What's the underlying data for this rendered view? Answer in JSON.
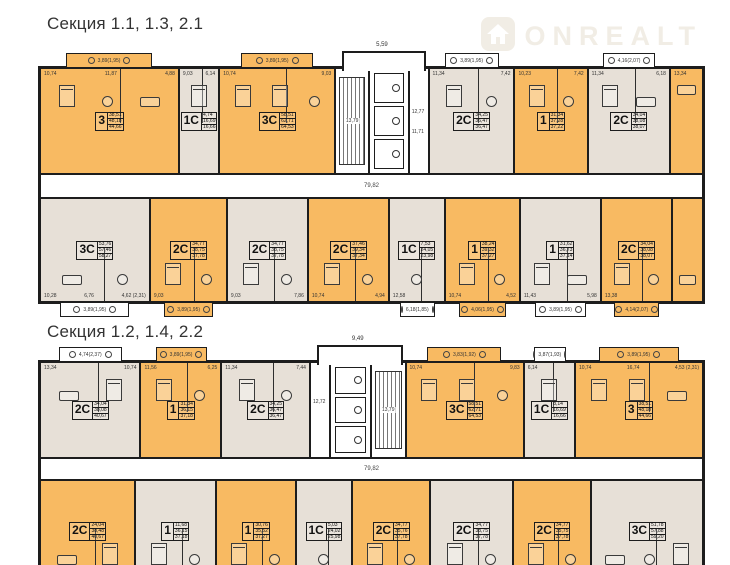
{
  "watermark": {
    "brand": "ONREALT",
    "color": "#f1ede5"
  },
  "colors": {
    "orange": "#f8ba62",
    "beige": "#e7e0d7",
    "wall": "#1d1d1d"
  },
  "sections": [
    {
      "title": "Секция 1.1, 1.3, 2.1",
      "corridor_label": "79,82",
      "core": {
        "stair_dim": "13,79",
        "hall_dims": [
          "12,77",
          "11,71"
        ],
        "top_dim": "5,59",
        "mirror": false
      },
      "rows": [
        {
          "units": [
            {
              "label": "3",
              "fill": "orange",
              "w": 150,
              "areas": [
                "38,51",
                "48,18",
                "44,66"
              ],
              "dims": [
                "10,74",
                "11,87",
                "4,88"
              ],
              "furn": [
                "bed",
                "table",
                "sofa"
              ],
              "balcony_top": "3,89(1,95)"
            },
            {
              "label": "1С",
              "fill": "beige",
              "w": 42,
              "areas": [
                "4,74",
                "16,69",
                "16,66"
              ],
              "dims": [
                "9,03",
                "6,14"
              ],
              "furn": [
                "bed"
              ]
            },
            {
              "label": "3С",
              "fill": "orange",
              "w": 125,
              "areas": [
                "58,51",
                "62,71",
                "64,53"
              ],
              "dims": [
                "10,74",
                "9,03"
              ],
              "furn": [
                "bed",
                "bed",
                "table"
              ],
              "balcony_top": "3,89(1,95)"
            },
            {
              "kind": "core",
              "w": 100
            },
            {
              "label": "2С",
              "fill": "beige",
              "w": 92,
              "areas": [
                "34,25",
                "36,47",
                "36,47"
              ],
              "dims": [
                "11,34",
                "7,42"
              ],
              "furn": [
                "bed",
                "table"
              ],
              "balcony_top": "3,89(1,95)"
            },
            {
              "label": "1",
              "fill": "orange",
              "w": 78,
              "areas": [
                "31,34",
                "37,28",
                "37,22"
              ],
              "dims": [
                "10,23",
                "7,42"
              ],
              "furn": [
                "bed",
                "table"
              ]
            },
            {
              "label": "2С",
              "fill": "beige",
              "w": 88,
              "areas": [
                "34,04",
                "38,08",
                "38,07"
              ],
              "dims": [
                "11,34",
                "6,18"
              ],
              "furn": [
                "bed",
                "sofa"
              ],
              "balcony_top": "4,16(2,07)"
            },
            {
              "label": "",
              "fill": "orange",
              "w": 34,
              "areas": [],
              "dims": [
                "13,34"
              ],
              "furn": [
                "sofa"
              ]
            }
          ]
        },
        {
          "units": [
            {
              "label": "3С",
              "fill": "beige",
              "w": 112,
              "areas": [
                "53,76",
                "57,46",
                "58,27"
              ],
              "dims": [
                "10,28",
                "6,76",
                "4,62 (2,31)"
              ],
              "furn": [
                "sofa",
                "table"
              ],
              "balcony_bottom": "3,89(1,95)"
            },
            {
              "label": "2С",
              "fill": "orange",
              "w": 78,
              "areas": [
                "34,77",
                "38,75",
                "37,78"
              ],
              "dims": [
                "9,03"
              ],
              "furn": [
                "bed",
                "table"
              ],
              "balcony_bottom": "3,89(1,95)"
            },
            {
              "label": "2С",
              "fill": "beige",
              "w": 82,
              "areas": [
                "34,77",
                "38,75",
                "37,78"
              ],
              "dims": [
                "9,03",
                "7,86"
              ],
              "furn": [
                "bed",
                "table"
              ]
            },
            {
              "label": "2С",
              "fill": "orange",
              "w": 82,
              "areas": [
                "37,46",
                "39,34",
                "37,34"
              ],
              "dims": [
                "10,74",
                "4,94"
              ],
              "furn": [
                "bed",
                "table"
              ]
            },
            {
              "label": "1С",
              "fill": "beige",
              "w": 56,
              "areas": [
                "7,53",
                "24,05",
                "23,98"
              ],
              "dims": [
                "12,58"
              ],
              "furn": [
                "table"
              ],
              "balcony_bottom": "6,18(1,85)"
            },
            {
              "label": "1",
              "fill": "orange",
              "w": 76,
              "areas": [
                "38,24",
                "39,32",
                "37,27"
              ],
              "dims": [
                "10,74",
                "4,52"
              ],
              "furn": [
                "bed",
                "table"
              ],
              "balcony_bottom": "4,06(1,95)"
            },
            {
              "label": "1",
              "fill": "beige",
              "w": 82,
              "areas": [
                "31,62",
                "36,73",
                "37,14"
              ],
              "dims": [
                "11,43",
                "5,98"
              ],
              "furn": [
                "bed",
                "sofa"
              ],
              "balcony_bottom": "3,89(1,95)"
            },
            {
              "label": "2С",
              "fill": "orange",
              "w": 72,
              "areas": [
                "34,04",
                "38,08",
                "38,07"
              ],
              "dims": [
                "13,38"
              ],
              "furn": [
                "bed",
                "table"
              ],
              "balcony_bottom": "4,14(2,07)"
            },
            {
              "label": "",
              "fill": "orange",
              "w": 30,
              "areas": [],
              "dims": [],
              "furn": [
                "sofa"
              ]
            }
          ]
        }
      ]
    },
    {
      "title": "Секция 1.2, 1.4, 2.2",
      "corridor_label": "79,82",
      "core": {
        "stair_dim": "13,79",
        "hall_dims": [
          "12,72"
        ],
        "top_dim": "9,49",
        "mirror": true
      },
      "rows": [
        {
          "units": [
            {
              "label": "2С",
              "fill": "beige",
              "w": 100,
              "areas": [
                "34,04",
                "38,08",
                "40,67"
              ],
              "dims": [
                "13,34",
                "10,74"
              ],
              "furn": [
                "sofa",
                "bed"
              ],
              "balcony_top": "4,74(2,37)"
            },
            {
              "label": "1",
              "fill": "orange",
              "w": 80,
              "areas": [
                "31,34",
                "36,15",
                "37,18"
              ],
              "dims": [
                "11,56",
                "6,25"
              ],
              "furn": [
                "bed",
                "table"
              ],
              "balcony_top": "3,89(1,95)"
            },
            {
              "label": "2С",
              "fill": "beige",
              "w": 88,
              "areas": [
                "34,25",
                "36,47",
                "36,47"
              ],
              "dims": [
                "11,34",
                "7,44"
              ],
              "furn": [
                "bed",
                "table"
              ]
            },
            {
              "kind": "core",
              "w": 95
            },
            {
              "label": "3С",
              "fill": "orange",
              "w": 118,
              "areas": [
                "58,51",
                "62,71",
                "64,53"
              ],
              "dims": [
                "10,74",
                "9,83"
              ],
              "furn": [
                "bed",
                "bed",
                "table"
              ],
              "balcony_top": "3,83(1,92)"
            },
            {
              "label": "1С",
              "fill": "beige",
              "w": 50,
              "areas": [
                "8,14",
                "16,69",
                "16,66"
              ],
              "dims": [
                "6,14"
              ],
              "furn": [
                "bed"
              ],
              "balcony_top": "3,87(1,93)"
            },
            {
              "label": "3",
              "fill": "orange",
              "w": 128,
              "areas": [
                "38,51",
                "48,18",
                "44,66"
              ],
              "dims": [
                "10,74",
                "16,74",
                "4,53 (2,31)"
              ],
              "furn": [
                "bed",
                "bed",
                "sofa"
              ],
              "balcony_top": "3,89(1,95)"
            }
          ]
        },
        {
          "units": [
            {
              "label": "2С",
              "fill": "orange",
              "w": 95,
              "areas": [
                "24,04",
                "38,48",
                "40,67"
              ],
              "dims": [
                "5,92",
                "4,86"
              ],
              "furn": [
                "sofa",
                "bed"
              ]
            },
            {
              "label": "1",
              "fill": "beige",
              "w": 80,
              "areas": [
                "11,68",
                "36,15",
                "37,18"
              ],
              "dims": [
                "9,89"
              ],
              "furn": [
                "bed",
                "table"
              ]
            },
            {
              "label": "1",
              "fill": "orange",
              "w": 80,
              "areas": [
                "30,76",
                "35,52",
                "37,27"
              ],
              "dims": [
                "6,92"
              ],
              "furn": [
                "bed",
                "table"
              ]
            },
            {
              "label": "1С",
              "fill": "beige",
              "w": 55,
              "areas": [
                "5,03",
                "24,02",
                "25,98"
              ],
              "dims": [
                "10,74"
              ],
              "furn": [
                "table"
              ]
            },
            {
              "label": "2С",
              "fill": "orange",
              "w": 78,
              "areas": [
                "34,77",
                "35,76",
                "37,78"
              ],
              "dims": [
                "4,04"
              ],
              "furn": [
                "bed",
                "table"
              ]
            },
            {
              "label": "2С",
              "fill": "beige",
              "w": 82,
              "areas": [
                "34,77",
                "38,75",
                "37,78"
              ],
              "dims": [
                "7,86",
                "4,66"
              ],
              "furn": [
                "bed",
                "table"
              ]
            },
            {
              "label": "2С",
              "fill": "orange",
              "w": 78,
              "areas": [
                "34,77",
                "35,75",
                "37,78"
              ],
              "dims": [
                "7,88",
                "4,84"
              ],
              "furn": [
                "bed",
                "table"
              ]
            },
            {
              "label": "3С",
              "fill": "beige",
              "w": 112,
              "areas": [
                "51,78",
                "57,88",
                "59,20"
              ],
              "dims": [
                "10,28",
                "6,76",
                "4,88"
              ],
              "furn": [
                "sofa",
                "table",
                "bed"
              ]
            }
          ]
        }
      ]
    }
  ]
}
